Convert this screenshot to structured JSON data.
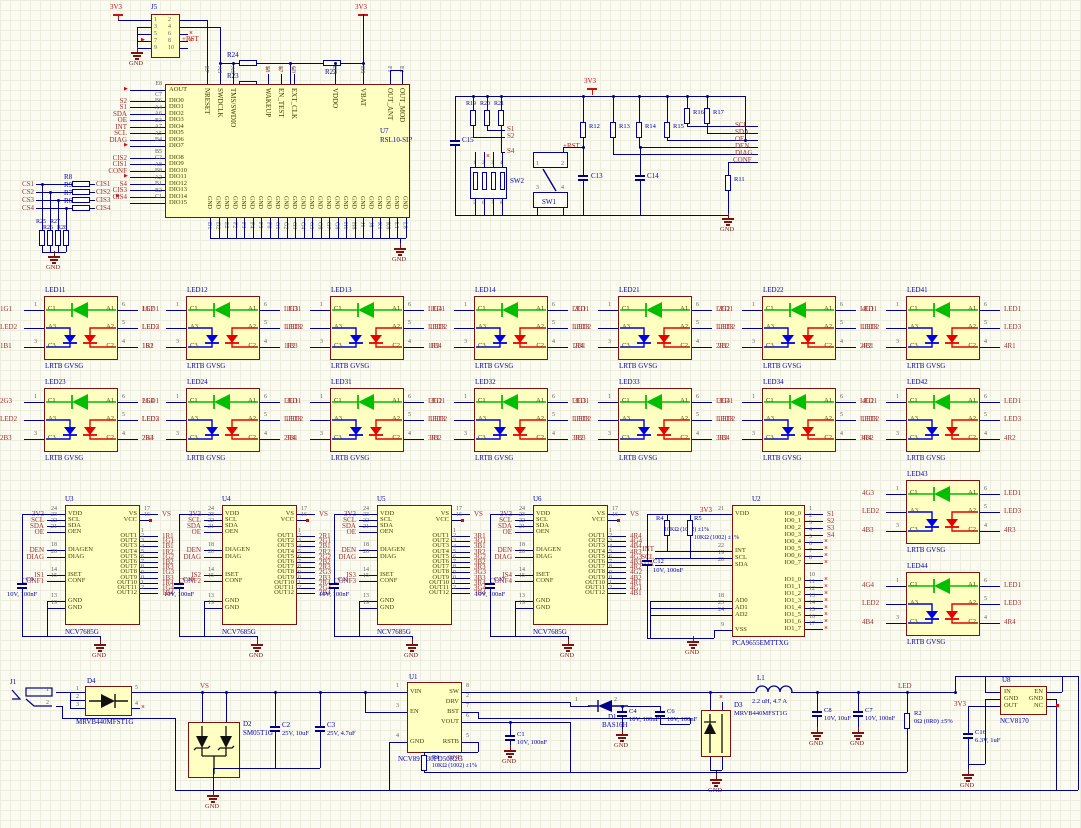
{
  "colors": {
    "wire": "#00008C",
    "border": "#7C1212",
    "fill": "#FFFFC2",
    "net": "#A03030",
    "pwr": "#C41414",
    "des": "#0000B4",
    "pin": "#404000",
    "num": "#606060",
    "gnd": "#7C1212",
    "green": "#00BE00",
    "blue": "#0000E6",
    "red": "#E60000",
    "black": "#101010"
  },
  "u7": {
    "ref": "U7",
    "part": "RSL10-SIP",
    "gnd_name": "GND",
    "left": [
      {
        "n": "AOUT",
        "d": "E8",
        "net": "",
        "y": 90,
        "nc": true
      },
      {
        "n": "DIO0",
        "d": "C7",
        "net": "S2",
        "y": 101
      },
      {
        "n": "DIO1",
        "d": "B6",
        "net": "S1",
        "y": 107
      },
      {
        "n": "DIO2",
        "d": "A4",
        "net": "SDA",
        "y": 114
      },
      {
        "n": "DIO3",
        "d": "A6",
        "net": "OE",
        "y": 120
      },
      {
        "n": "DIO4",
        "d": "B3",
        "net": "INT",
        "y": 127
      },
      {
        "n": "DIO5",
        "d": "A7",
        "net": "SCL",
        "y": 133
      },
      {
        "n": "DIO6",
        "d": "A5",
        "net": "DIAG",
        "y": 140
      },
      {
        "n": "DIO7",
        "d": "B4",
        "net": "",
        "y": 146,
        "nc": true
      },
      {
        "n": "DIO8",
        "d": "B5",
        "net": "CIS2",
        "y": 158
      },
      {
        "n": "DIO9",
        "d": "C2",
        "net": "CIS1",
        "y": 164
      },
      {
        "n": "DIO10",
        "d": "A8",
        "net": "CONF",
        "y": 171
      },
      {
        "n": "DIO11",
        "d": "B8",
        "net": "",
        "y": 177,
        "nc": true
      },
      {
        "n": "DIO12",
        "d": "A2",
        "net": "S4",
        "y": 184
      },
      {
        "n": "DIO13",
        "d": "B1",
        "net": "CIS3",
        "y": 190
      },
      {
        "n": "DIO14",
        "d": "B2",
        "net": "CIS4",
        "y": 197,
        "nc": true
      },
      {
        "n": "DIO15",
        "d": "C1",
        "net": "",
        "y": 203
      }
    ],
    "top": [
      {
        "n": "NRESET",
        "d": "E7",
        "x": 207
      },
      {
        "n": "SWDCLK",
        "d": "A3",
        "x": 220
      },
      {
        "n": "TMS/SWDIO",
        "d": "A1",
        "x": 233
      },
      {
        "n": "WAKEUP",
        "d": "F8",
        "x": 268,
        "nc": true
      },
      {
        "n": "EN_TEST",
        "d": "F7",
        "x": 281,
        "nc": true
      },
      {
        "n": "EXT_CLK",
        "d": "C8",
        "x": 294,
        "nc": true
      },
      {
        "n": "VDDO",
        "d": "D7",
        "x": 335
      },
      {
        "n": "VBAT",
        "d": "D8",
        "x": 363
      },
      {
        "n": "OUT_ANT",
        "d": "F1",
        "x": 390
      },
      {
        "n": "OUT_MOD",
        "d": "E1",
        "x": 402
      }
    ],
    "gnd_pins": [
      "D1",
      "D2",
      "E2",
      "F2",
      "F3",
      "F4",
      "F5",
      "F6",
      "G1",
      "G2",
      "G3",
      "G4",
      "G5",
      "G6",
      "G7",
      "G8",
      "H1",
      "H8",
      "J1",
      "J8",
      "K1",
      "K8",
      "L1",
      "L8"
    ]
  },
  "j5": {
    "ref": "J5",
    "lnums": [
      "1",
      "3",
      "5",
      "7",
      "9"
    ],
    "rnums": [
      "2",
      "4",
      "6",
      "8",
      "10"
    ],
    "v3": "3V3",
    "rst": "+RST",
    "r24": "R24",
    "r23": "R23",
    "r22": "R22"
  },
  "cs": {
    "rows": [
      {
        "cs": "CS1",
        "r": "R8",
        "cis": "CIS1"
      },
      {
        "cs": "CS2",
        "r": "R9",
        "cis": "CIS2"
      },
      {
        "cs": "CS3",
        "r": "R7",
        "cis": "CIS3"
      },
      {
        "cs": "CS4",
        "r": "R6",
        "cis": "CIS4"
      }
    ],
    "sh": [
      "R25",
      "R27",
      "R26",
      "R28"
    ]
  },
  "sw": {
    "rtop": [
      "R19",
      "R20",
      "R21"
    ],
    "slbl": [
      "S1",
      "S2",
      "S4"
    ],
    "c15": "C15",
    "sw2": {
      "ref": "SW2",
      "top": [
        "1",
        "2",
        "3",
        "4"
      ],
      "bot": [
        "5",
        "6",
        "7",
        "8"
      ]
    },
    "sw1": {
      "ref": "SW1",
      "nums": [
        "1",
        "2",
        "3",
        "4"
      ]
    },
    "rst": "+RST",
    "v3": "3V3",
    "r12": "R12",
    "r13": "R13",
    "r14": "R14",
    "r15": "R15",
    "r16": "R16",
    "r17": "R17",
    "r11": "R11",
    "c13": "C13",
    "c14": "C14",
    "nets": [
      "SCL",
      "SDA",
      "OE",
      "DEN",
      "DIAG",
      "CONF"
    ]
  },
  "leds": {
    "part": "LRTB GVSG",
    "a1": "LED1",
    "a2": "LED3",
    "a3": "LED2",
    "pins": {
      "c1": "C1",
      "a1": "A1",
      "a3": "A3",
      "a2": "A2",
      "c3": "C3",
      "c2": "C2"
    },
    "nums": {
      "p1": "1",
      "p3": "3",
      "p6": "6",
      "p5": "5",
      "p4": "4"
    },
    "blocks": [
      {
        "ref": "LED11",
        "x": 44,
        "y": 296,
        "g": "1G1",
        "b": "1B1",
        "r": "1R1"
      },
      {
        "ref": "LED12",
        "x": 186,
        "y": 296,
        "g": "1G2",
        "b": "1B2",
        "r": "1R2"
      },
      {
        "ref": "LED13",
        "x": 330,
        "y": 296,
        "g": "1G3",
        "b": "1B3",
        "r": "1R3"
      },
      {
        "ref": "LED14",
        "x": 474,
        "y": 296,
        "g": "1G4",
        "b": "1B4",
        "r": "1R4"
      },
      {
        "ref": "LED21",
        "x": 618,
        "y": 296,
        "g": "2G1",
        "b": "2B1",
        "r": "2R1"
      },
      {
        "ref": "LED22",
        "x": 762,
        "y": 296,
        "g": "2G2",
        "b": "2B2",
        "r": "2R2"
      },
      {
        "ref": "LED41",
        "x": 906,
        "y": 296,
        "g": "4G1",
        "b": "4B1",
        "r": "4R1"
      },
      {
        "ref": "LED23",
        "x": 44,
        "y": 388,
        "g": "2G3",
        "b": "2B3",
        "r": "2R3"
      },
      {
        "ref": "LED24",
        "x": 186,
        "y": 388,
        "g": "2G4",
        "b": "2B4",
        "r": "2R4"
      },
      {
        "ref": "LED31",
        "x": 330,
        "y": 388,
        "g": "3G1",
        "b": "3B1",
        "r": "3R1"
      },
      {
        "ref": "LED32",
        "x": 474,
        "y": 388,
        "g": "3G2",
        "b": "3B2",
        "r": "3R2"
      },
      {
        "ref": "LED33",
        "x": 618,
        "y": 388,
        "g": "3G3",
        "b": "3B3",
        "r": "3R3"
      },
      {
        "ref": "LED34",
        "x": 762,
        "y": 388,
        "g": "3G4",
        "b": "3B4",
        "r": "3R4"
      },
      {
        "ref": "LED42",
        "x": 906,
        "y": 388,
        "g": "4G2",
        "b": "4B2",
        "r": "4R2"
      },
      {
        "ref": "LED43",
        "x": 906,
        "y": 480,
        "g": "4G3",
        "b": "4B3",
        "r": "4R3"
      },
      {
        "ref": "LED44",
        "x": 906,
        "y": 572,
        "g": "4G4",
        "b": "4B4",
        "r": "4R4"
      }
    ]
  },
  "drv": {
    "part": "NCV7685G",
    "cap_val": "10V, 100nF",
    "vs": "VS",
    "v3": "3V3",
    "lnames": [
      "VDD",
      "SCL",
      "SDA",
      "OEN",
      "DIAGEN",
      "DIAG",
      "ISET",
      "CONF",
      "GND",
      "GND"
    ],
    "lnums": [
      "24",
      "23",
      "22",
      "21",
      "18",
      "20",
      "14",
      "15",
      "13",
      "19"
    ],
    "loff": [
      9,
      15,
      21,
      27,
      45,
      52,
      70,
      76,
      96,
      103
    ],
    "lnets": [
      "3V3",
      "SCL",
      "SDA",
      "OE",
      "DEN",
      "DIAG",
      "IS",
      "CONF",
      "",
      ""
    ],
    "rvs": {
      "name": "VS",
      "num": "17"
    },
    "rvcc": {
      "name": "VCC",
      "num": "16"
    },
    "outs": [
      "OUT1",
      "OUT2",
      "OUT3",
      "OUT4",
      "OUT5",
      "OUT6",
      "OUT7",
      "OUT8",
      "OUT9",
      "OUT10",
      "OUT11",
      "OUT12"
    ],
    "units": [
      {
        "ref": "U3",
        "x": 65,
        "cap": "C9",
        "iset": "IS1",
        "conf": "CONF1",
        "nets": [
          "1R1",
          "1G1",
          "1B1",
          "1R2",
          "1G2",
          "1B2",
          "1R3",
          "1G3",
          "1B3",
          "1R4",
          "1G4",
          "1B4"
        ]
      },
      {
        "ref": "U4",
        "x": 222,
        "cap": "C10",
        "iset": "IS2",
        "conf": "CONF2",
        "nets": [
          "2R1",
          "2G1",
          "2B1",
          "2R2",
          "2G2",
          "2B2",
          "2R3",
          "2G3",
          "2B3",
          "2R4",
          "2G4",
          "2B4"
        ]
      },
      {
        "ref": "U5",
        "x": 377,
        "cap": "C11",
        "iset": "IS3",
        "conf": "CONF3",
        "nets": [
          "3R1",
          "3G1",
          "3B1",
          "3R2",
          "3G2",
          "3B2",
          "3R3",
          "3G3",
          "3B3",
          "3R4",
          "3G4",
          "3B4"
        ]
      },
      {
        "ref": "U6",
        "x": 533,
        "cap": "C17",
        "iset": "IS4",
        "conf": "CONF4",
        "nets": [
          "4R4",
          "4G4",
          "4B4",
          "4R3",
          "4G3",
          "4B3",
          "4R2",
          "4G2",
          "4B2",
          "4R1",
          "4G1",
          "4B1"
        ]
      }
    ]
  },
  "u2": {
    "ref": "U2",
    "part": "PCA9655EMTTXG",
    "v3": "3V3",
    "gnd": "GND",
    "left": [
      {
        "n": "VDD",
        "num": "21",
        "y": 514
      },
      {
        "n": "INT",
        "num": "22",
        "y": 551,
        "net": "INT"
      },
      {
        "n": "SCL",
        "num": "19",
        "y": 558,
        "net": "SCL"
      },
      {
        "n": "SDA",
        "num": "20",
        "y": 565,
        "net": "SDA"
      },
      {
        "n": "AD0",
        "num": "18",
        "y": 601
      },
      {
        "n": "AD1",
        "num": "23",
        "y": 608
      },
      {
        "n": "AD2",
        "num": "24",
        "y": 615
      },
      {
        "n": "VSS",
        "num": "9",
        "y": 630
      }
    ],
    "right0": {
      "names": [
        "IO0_0",
        "IO0_1",
        "IO0_2",
        "IO0_3",
        "IO0_4",
        "IO0_5",
        "IO0_6",
        "IO0_7"
      ],
      "nums": [
        "1",
        "2",
        "3",
        "4",
        "5",
        "6",
        "7",
        "8"
      ],
      "nets": [
        "S1",
        "S2",
        "S3",
        "S4"
      ]
    },
    "right1": {
      "names": [
        "IO1_0",
        "IO1_1",
        "IO1_2",
        "IO1_3",
        "IO1_4",
        "IO1_5",
        "IO1_6",
        "IO1_7"
      ],
      "nums": [
        "10",
        "11",
        "12",
        "13",
        "14",
        "15",
        "16",
        "17"
      ]
    },
    "r4": {
      "ref": "R4",
      "val": "10KΩ (1002) ±1%"
    },
    "r5": {
      "ref": "R5",
      "val": "10KΩ (1002) ±1%"
    },
    "c12": {
      "ref": "C12",
      "val": "10V, 100nF"
    }
  },
  "pwr": {
    "j1": "J1",
    "vs": "VS",
    "led": "LED",
    "v3": "3V3",
    "gnd": "GND",
    "d4": {
      "ref": "D4",
      "part": "MRVB440MFST1G",
      "lnums": [
        "1",
        "2",
        "3"
      ],
      "rnums": [
        "5",
        "4"
      ]
    },
    "d2": {
      "ref": "D2",
      "part": "SM05T1G"
    },
    "c2": {
      "ref": "C2",
      "val": "25V, 10uF"
    },
    "c3": {
      "ref": "C3",
      "val": "25V, 4.7uF"
    },
    "u1": {
      "ref": "U1",
      "part": "NCV891330PD50R2G",
      "left": [
        [
          "VIN",
          "1"
        ],
        [
          "EN",
          "3"
        ],
        [
          "GND",
          "4"
        ]
      ],
      "right": [
        [
          "SW",
          "8"
        ],
        [
          "DRV",
          "2"
        ],
        [
          "BST",
          "7"
        ],
        [
          "VOUT",
          "6"
        ],
        [
          "RSTB",
          "5"
        ]
      ]
    },
    "c1": {
      "ref": "C1",
      "val": "10V, 100nF"
    },
    "r1": {
      "ref": "R1",
      "val": "10KΩ (1002) ±1%",
      "gnd": "GND"
    },
    "d1": {
      "ref": "D1",
      "part": "BAS16H",
      "nums": [
        "1",
        "2"
      ]
    },
    "c4": {
      "ref": "C4",
      "val": "10V, 100nF"
    },
    "c6": {
      "ref": "C6",
      "val": "10V, 100nF"
    },
    "d3": {
      "ref": "D3",
      "part": "MRVB440MFST1G"
    },
    "l1": {
      "ref": "L1",
      "val": "2.2 uH, 4.7 A"
    },
    "c8": {
      "ref": "C8",
      "val": "10V, 10uF"
    },
    "c7": {
      "ref": "C7",
      "val": "10V, 100nF"
    },
    "r2": {
      "ref": "R2",
      "val": "0Ω (0R0) ±5%"
    },
    "u8": {
      "ref": "U8",
      "part": "NCV8170",
      "left": [
        "IN",
        "GND",
        "OUT"
      ],
      "right": [
        "EN",
        "GND",
        "NC"
      ]
    },
    "c16": {
      "ref": "C16",
      "val": "6.3V, 1uF"
    }
  }
}
